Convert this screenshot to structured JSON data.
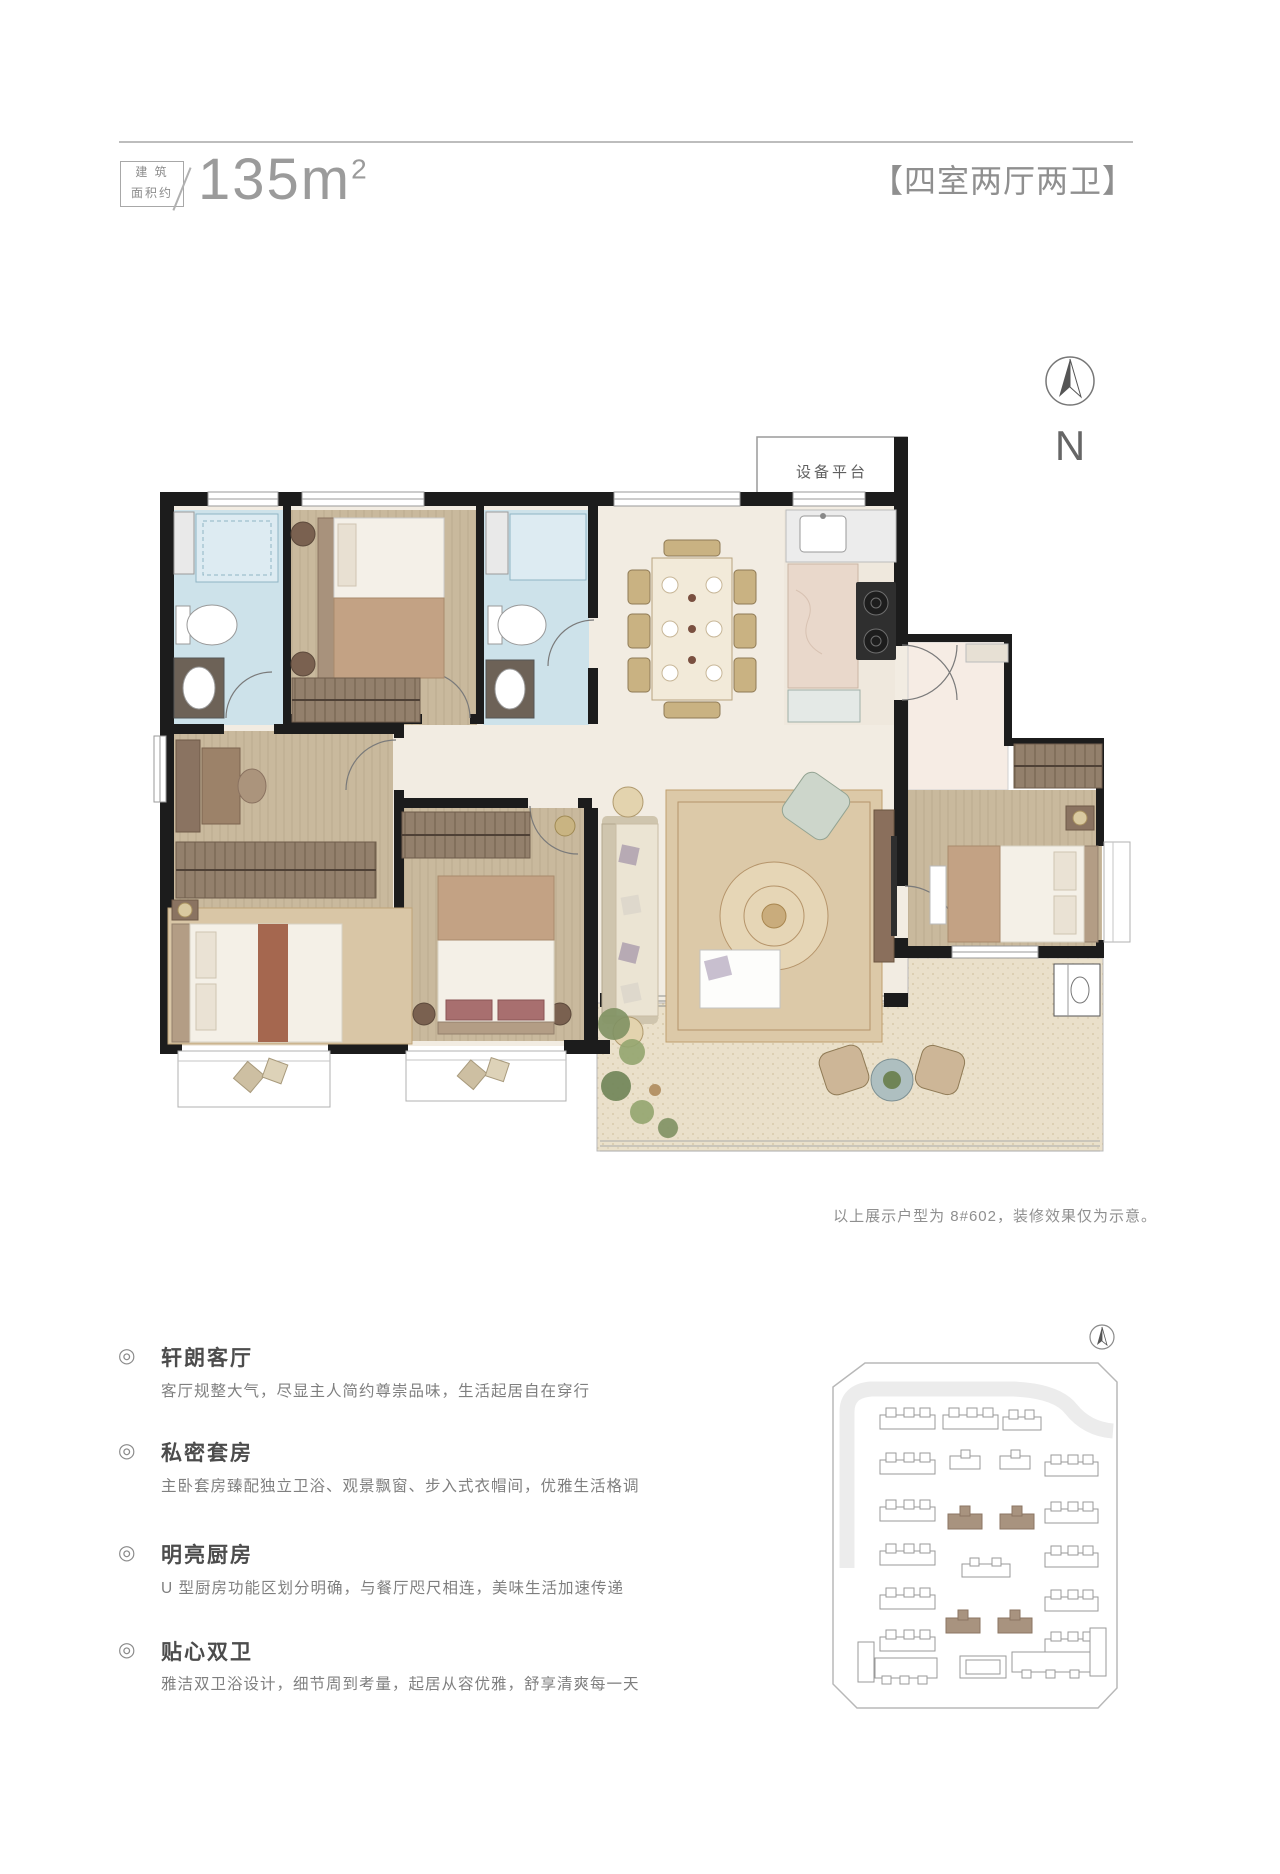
{
  "header": {
    "area_label_line1": "建 筑",
    "area_label_line2": "面积约",
    "area_value": "135m",
    "area_sup": "2",
    "type_title": "【四室两厅两卫】"
  },
  "plan": {
    "equipment_platform_label": "设备平台",
    "north_label": "N"
  },
  "caption": {
    "text": "以上展示户型为 8#602，装修效果仅为示意。"
  },
  "feature_bullet": "◎",
  "features": [
    {
      "title": "轩朗客厅",
      "desc": "客厅规整大气，尽显主人简约尊崇品味，生活起居自在穿行"
    },
    {
      "title": "私密套房",
      "desc": "主卧套房臻配独立卫浴、观景飘窗、步入式衣帽间，优雅生活格调"
    },
    {
      "title": "明亮厨房",
      "desc": "U 型厨房功能区划分明确，与餐厅咫尺相连，美味生活加速传递"
    },
    {
      "title": "贴心双卫",
      "desc": "雅洁双卫浴设计，细节周到考量，起居从容优雅，舒享清爽每一天"
    }
  ],
  "colors": {
    "wall": "#1c1c1c",
    "wood_floor": "#c9b99d",
    "cream_floor": "#f2ece2",
    "bathroom_tile": "#cde2ea",
    "balcony_floor": "#eae0ca",
    "highlight_building": "#a8937f",
    "text_gray": "#8f8f8f"
  }
}
